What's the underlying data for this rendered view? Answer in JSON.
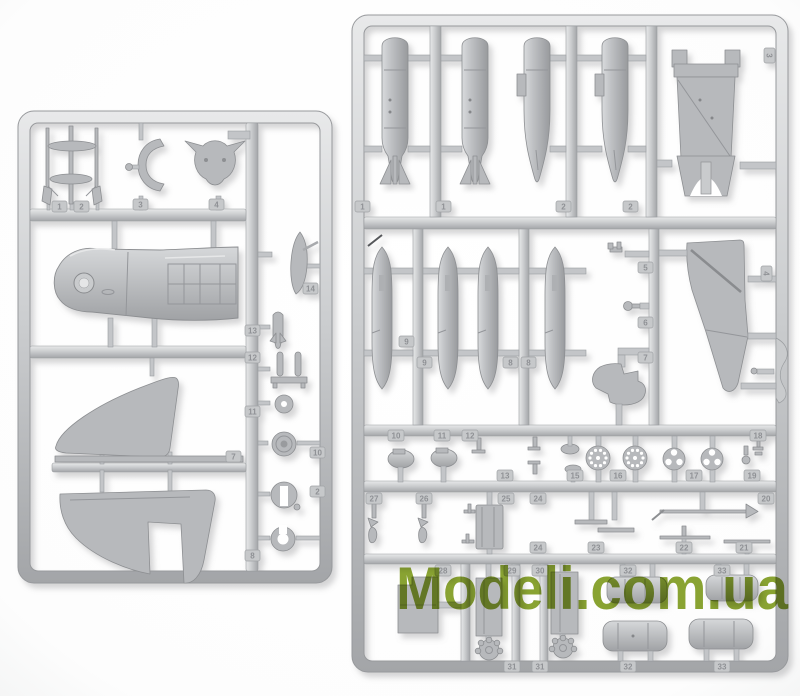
{
  "photo": {
    "background_color": "#ffffff",
    "plastic_color": "#c7c9cb",
    "part_color": "#b7b9bc"
  },
  "watermark": {
    "text": "Modeli.com.ua",
    "color": "#7d9a1b"
  },
  "sprue_a": {
    "tags": [
      "1",
      "2",
      "3",
      "4",
      "14",
      "13",
      "12",
      "11",
      "10",
      "2",
      "8",
      "7"
    ]
  },
  "sprue_b": {
    "tags_top": [
      "1",
      "1",
      "2",
      "2",
      "3"
    ],
    "tags_floats": [
      "9",
      "9",
      "8",
      "8"
    ],
    "tags_small_parts": [
      "5",
      "6",
      "7",
      "4"
    ],
    "tags_row1_top": [
      "10",
      "11",
      "12",
      "18"
    ],
    "tags_row1_bottom": [
      "13",
      "15",
      "16",
      "17",
      "19"
    ],
    "tags_row2_top": [
      "27",
      "26",
      "25",
      "24",
      "20"
    ],
    "tags_row2_bottom": [
      "24",
      "23",
      "22",
      "21"
    ],
    "tags_row3_top": [
      "28",
      "29",
      "30",
      "32",
      "33"
    ],
    "tags_row3_bottom": [
      "31",
      "31",
      "32",
      "33"
    ]
  }
}
